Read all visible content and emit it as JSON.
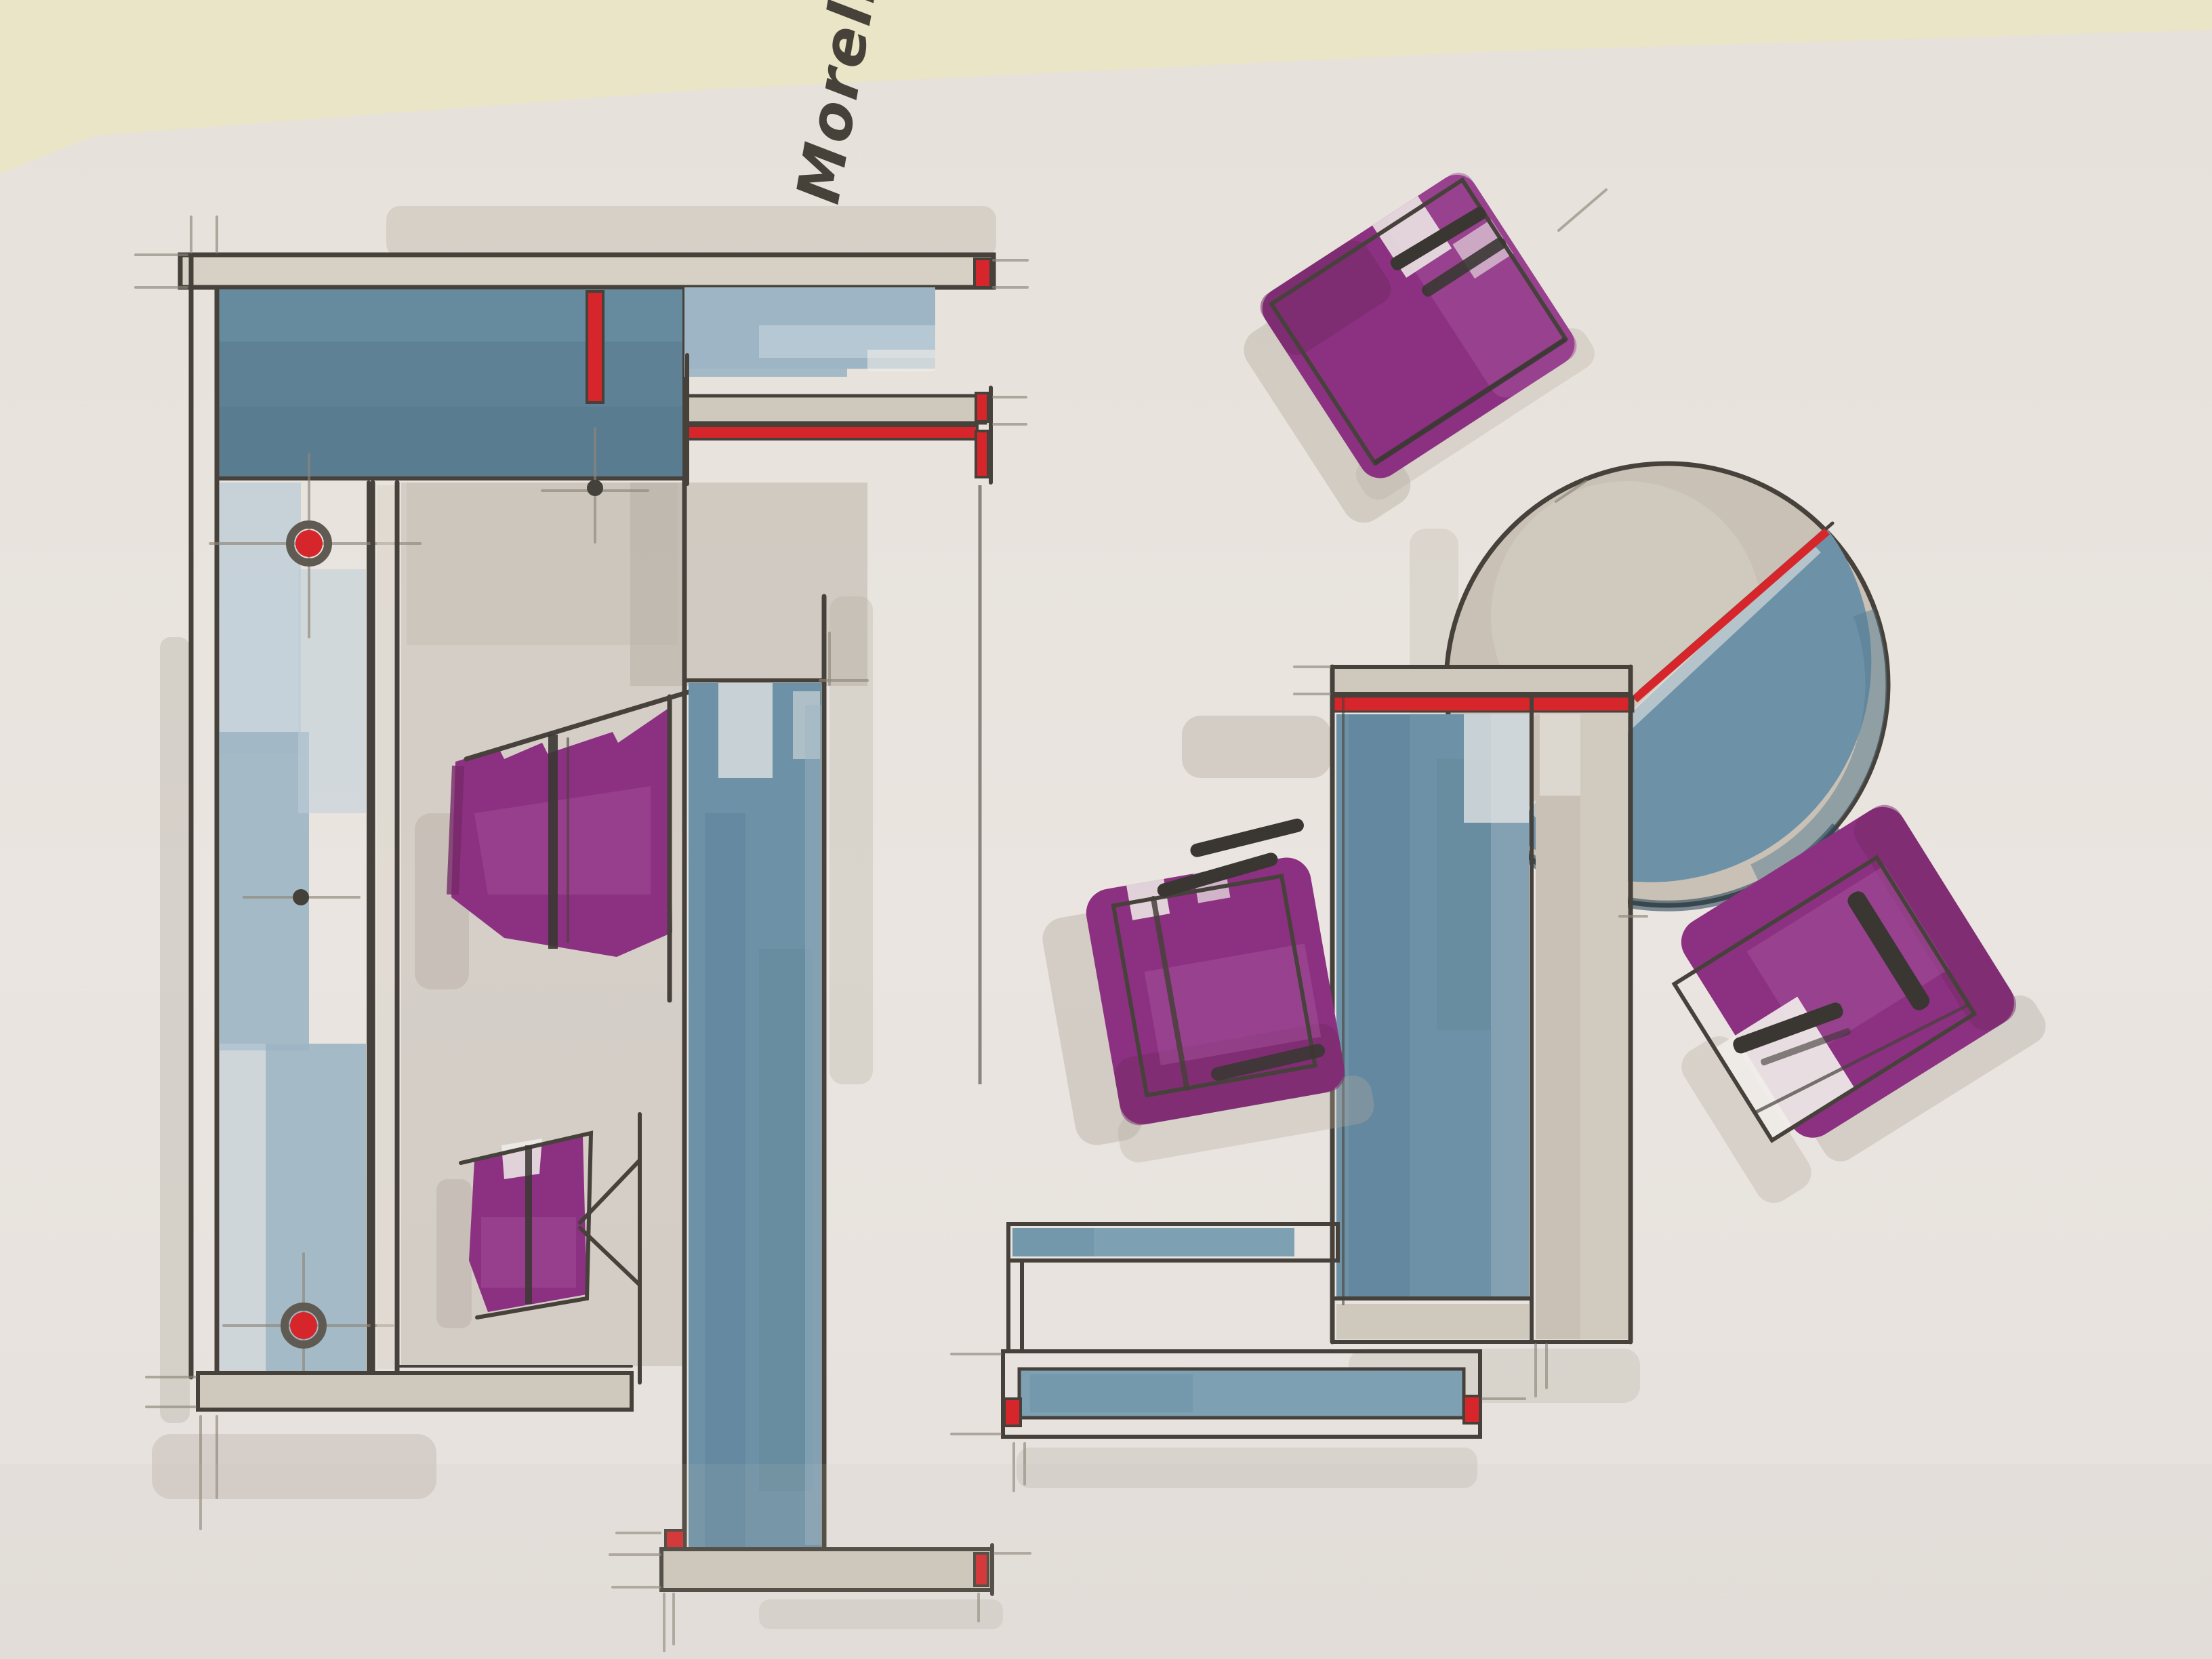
{
  "artwork": {
    "signature": "Morello '18"
  },
  "colors": {
    "table": "#e9e5c6",
    "paper": "#e8e3dd",
    "paper-light": "#f0ede9",
    "ink": "#46413a",
    "pencil": "#8d867a",
    "taupe": "#c9c1b5",
    "taupe-light": "#d7d1c5",
    "strip": "#cfc8bc",
    "blue-dark": "#5e8195",
    "blue": "#6d91a6",
    "blue-mid": "#7da0b2",
    "blue-light": "#9db5c4",
    "blue-pale": "#bdcdd7",
    "navy": "#2f4a5c",
    "purple": "#8c3181",
    "purple-dark": "#752968",
    "purple-light": "#a4529b",
    "red": "#d6262b",
    "bar": "#3a3733",
    "shadow": "#b3aba0"
  }
}
